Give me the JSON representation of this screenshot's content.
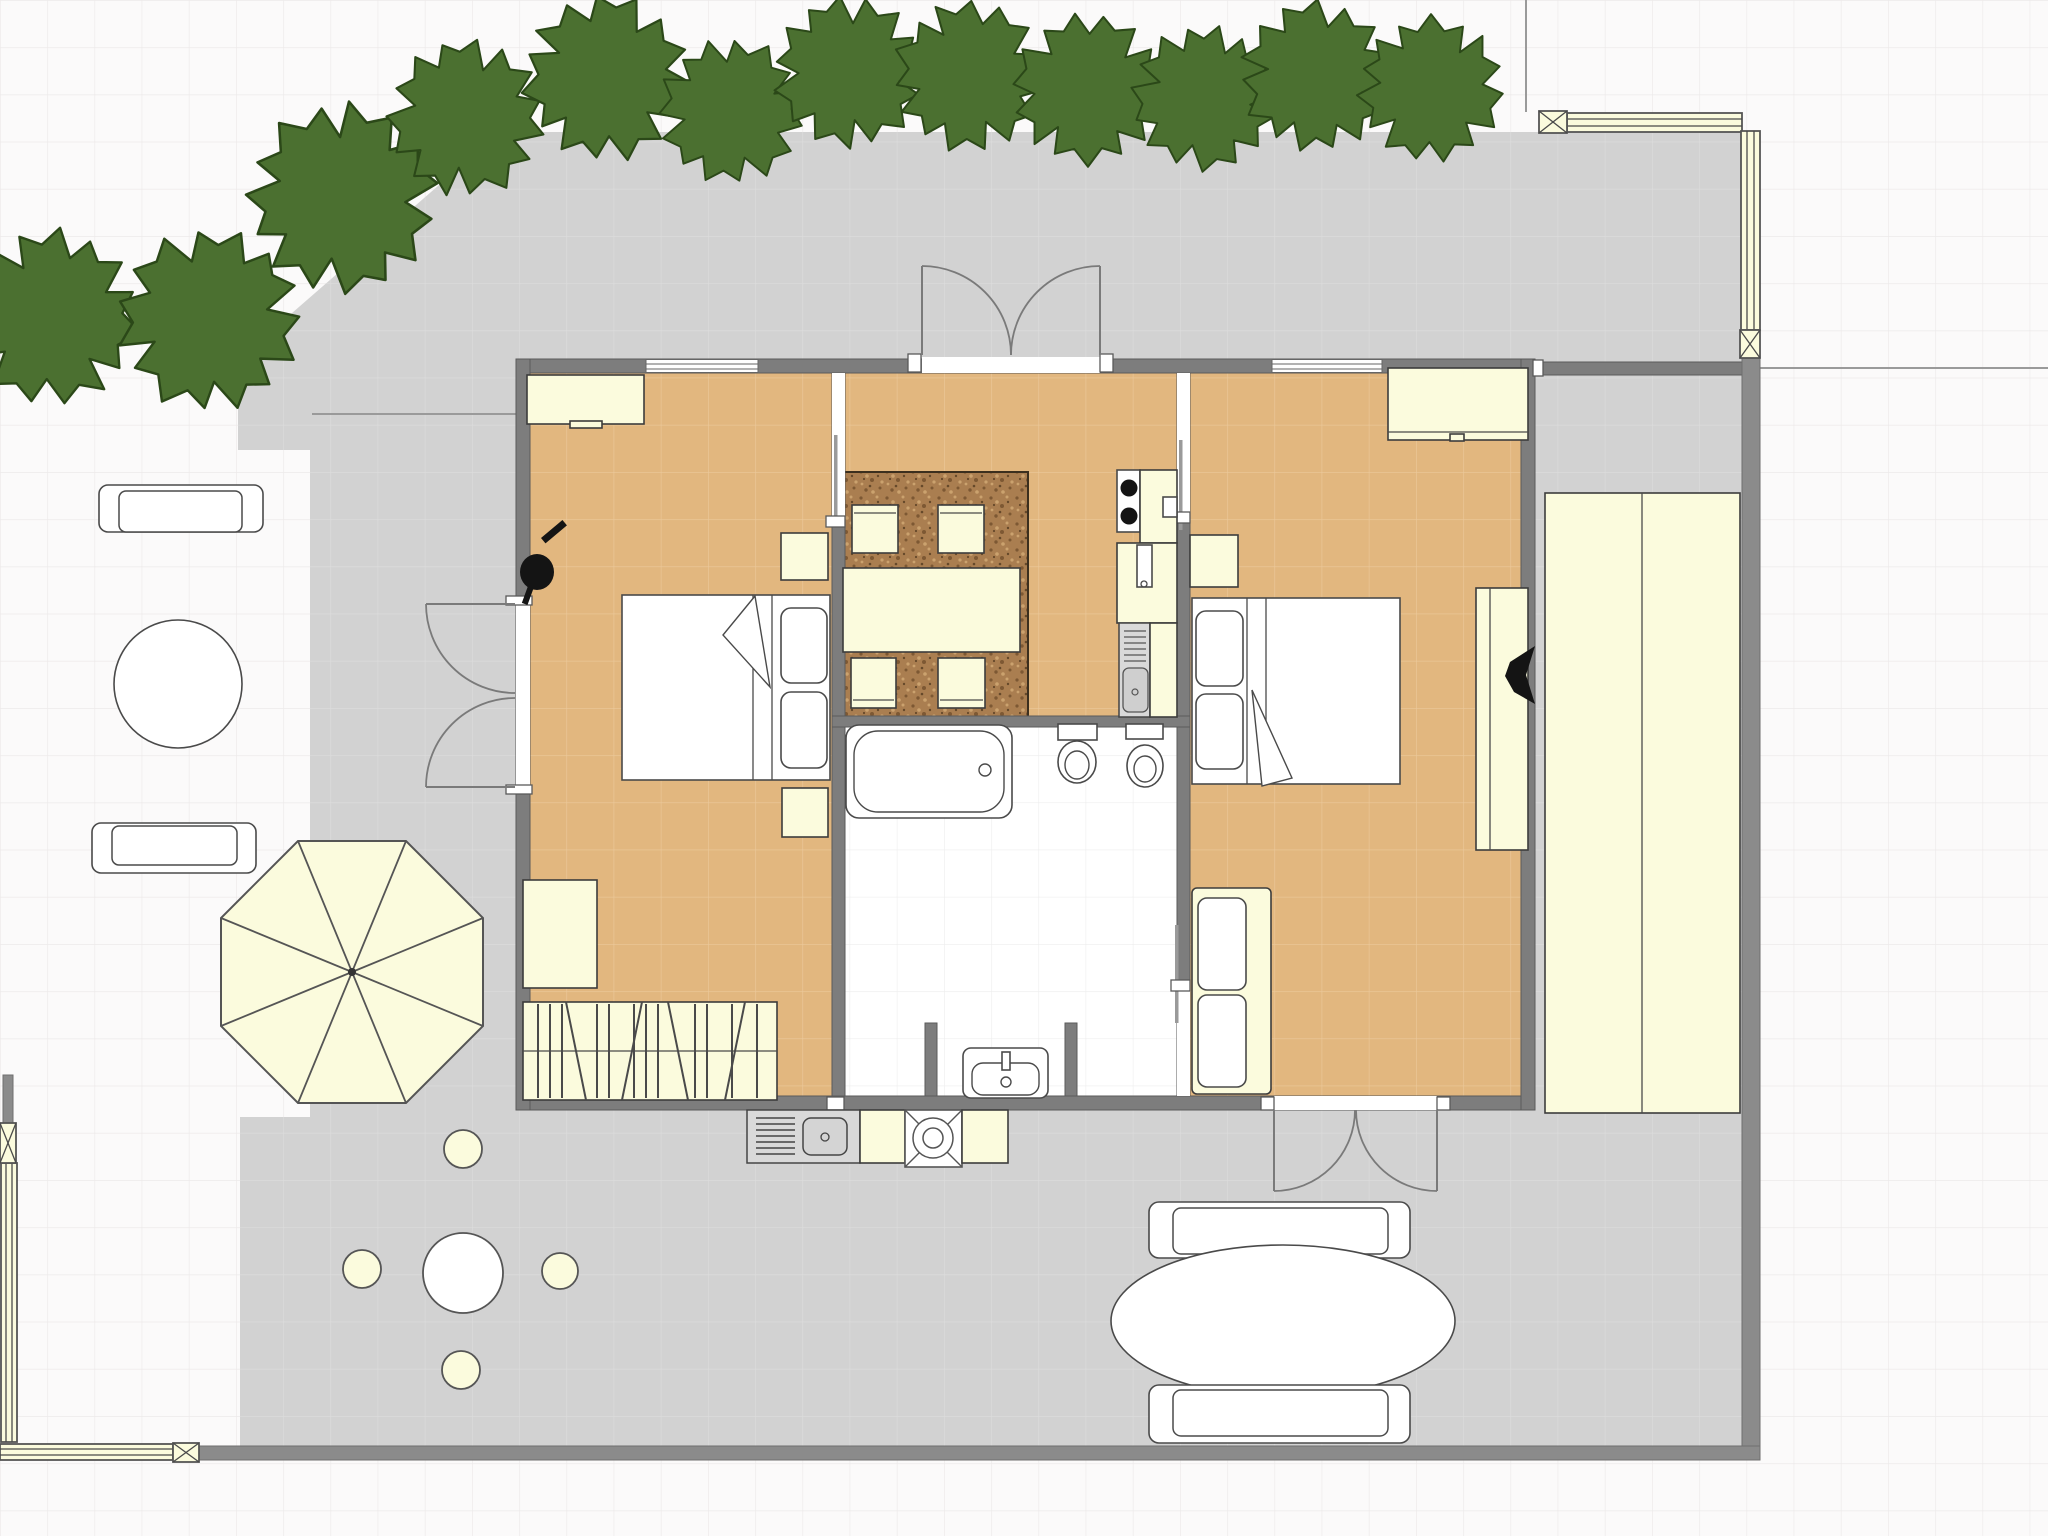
{
  "app": {
    "title": "House floor plan with garden and patio"
  },
  "colors": {
    "bg": "#fbfafa",
    "grid": "#edeaea",
    "patio": "#d2d2d2",
    "patioGrid": "#dddddd",
    "tan": "#e2b77f",
    "tanGrid": "#ecc99b",
    "bathGrid": "#ededed",
    "wall": "#7d7d7d",
    "cream": "#fbfbdd",
    "tree": "#4b7030",
    "treeStroke": "#2b4818",
    "rug": "#aa7e50"
  },
  "plan": {
    "rooms": {
      "bedroom_left": {
        "label": "Bedroom (left), tiled tan floor"
      },
      "living_kitchen": {
        "label": "Living / dining room with kitchen strip"
      },
      "bathroom": {
        "label": "Bathroom with tub, two toilets and sink alcove"
      },
      "bedroom_right": {
        "label": "Bedroom (right), tiled tan floor"
      },
      "patio": {
        "label": "Gray paved patio / terrace"
      },
      "garden": {
        "label": "Garden with tree hedge"
      }
    },
    "furniture": {
      "dresser_left": {
        "label": "dresser"
      },
      "bed_left": {
        "label": "double bed with two pillows"
      },
      "nightstand": {
        "label": "nightstand"
      },
      "plant_left": {
        "label": "potted plant (black symbol)"
      },
      "armchair_left": {
        "label": "side table / chair"
      },
      "closet_left": {
        "label": "wardrobe with clothes rail"
      },
      "dining_rug": {
        "label": "speckled brown rug"
      },
      "dining_table": {
        "label": "dining table"
      },
      "dining_chair": {
        "label": "dining chair"
      },
      "stove": {
        "label": "stove with two burners"
      },
      "kitchen_counter": {
        "label": "kitchen counter"
      },
      "kitchen_cabinet": {
        "label": "kitchen cabinet / fridge"
      },
      "kitchen_sink": {
        "label": "kitchen sink with drainboard"
      },
      "bathtub": {
        "label": "bathtub"
      },
      "toilet": {
        "label": "toilet"
      },
      "bath_sink": {
        "label": "pedestal washbasin"
      },
      "dresser_right": {
        "label": "dresser"
      },
      "bed_right": {
        "label": "double bed with two pillows"
      },
      "sofa_right": {
        "label": "sofa / cushioned cabinet"
      },
      "desk_right": {
        "label": "desk with plant"
      },
      "plant_right": {
        "label": "plant (black symbol)"
      },
      "wardrobe_out": {
        "label": "tall double wardrobe along east wall"
      },
      "umbrella": {
        "label": "octagonal parasol"
      },
      "bench": {
        "label": "garden bench"
      },
      "round_table": {
        "label": "round garden table"
      },
      "stool": {
        "label": "round stool"
      },
      "oval_table": {
        "label": "oval outdoor dining table"
      },
      "outdoor_sink": {
        "label": "outdoor sink unit"
      },
      "grill": {
        "label": "outdoor grill / cooker"
      },
      "pergola": {
        "label": "pergola beam with cross posts"
      },
      "tree": {
        "label": "garden tree"
      }
    },
    "doors": {
      "french_west": {
        "label": "double French door, west wall, opens out"
      },
      "double_north": {
        "label": "double door, north wall, opens out"
      },
      "double_south": {
        "label": "double door, south wall of right bedroom"
      },
      "slide_left": {
        "label": "sliding door to left bedroom"
      },
      "slide_right": {
        "label": "sliding door to right bedroom"
      },
      "bath_door": {
        "label": "bathroom pocket door"
      }
    },
    "counts": {
      "trees": 12,
      "dining_chairs": 4,
      "toilets": 2,
      "stools": 4,
      "garden_benches": 2,
      "patio_benches": 2
    }
  }
}
